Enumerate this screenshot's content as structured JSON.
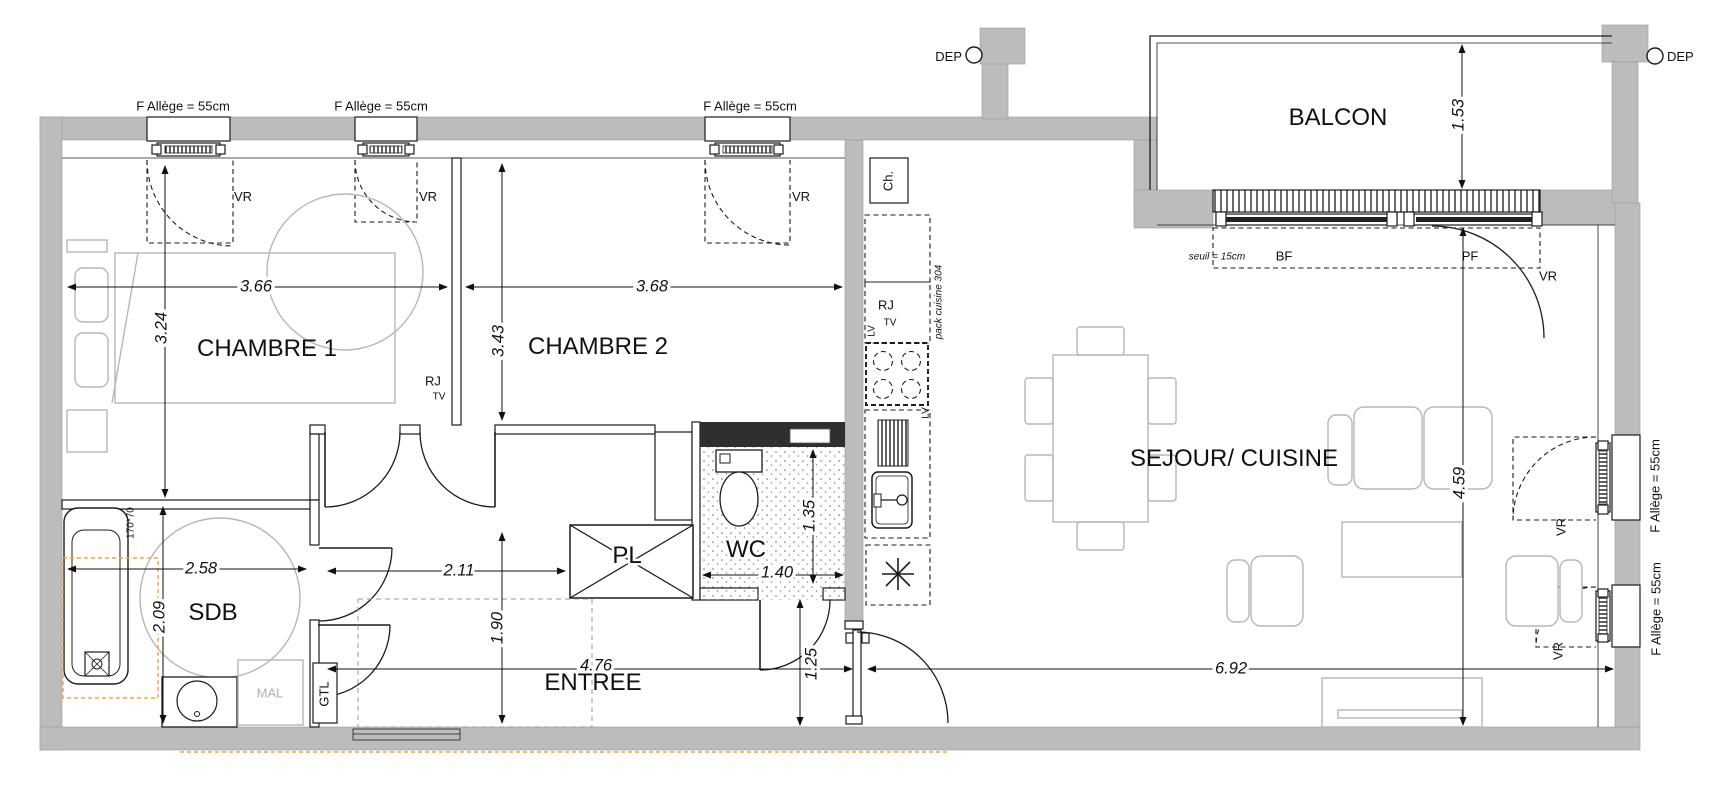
{
  "plan_texts": {
    "window_label": "F  Allège = 55cm",
    "vr": "VR",
    "dep": "DEP",
    "seuil": "seuil = 15cm",
    "bf": "BF",
    "pf": "PF",
    "ch": "Ch.",
    "rj": "RJ",
    "tv": "TV",
    "lv": "LV",
    "pack_cuisine": "pack cuisine 304",
    "gtl": "GTL",
    "mal": "MAL",
    "tub_size": "170*70"
  },
  "rooms": {
    "chambre1": {
      "label": "CHAMBRE 1",
      "width": "3.66",
      "height": "3.24"
    },
    "chambre2": {
      "label": "CHAMBRE 2",
      "width": "3.68",
      "height": "3.43"
    },
    "sdb": {
      "label": "SDB",
      "width": "2.58",
      "height": "2.09"
    },
    "wc": {
      "label": "WC",
      "width": "1.40",
      "height": "1.35"
    },
    "pl": {
      "label": "PL"
    },
    "entree": {
      "label": "ENTREE",
      "length": "4.76",
      "hall": "2.11",
      "width": "1.90",
      "passage": "1.25"
    },
    "sejour": {
      "label": "SEJOUR/ CUISINE",
      "length": "6.92",
      "width": "4.59"
    },
    "balcon": {
      "label": "BALCON",
      "depth": "1.53"
    }
  },
  "colors": {
    "wall": "#bcbcbc",
    "line": "#1c1c1c",
    "furniture": "#b7b7b7",
    "accent_orange": "#f2a33c"
  }
}
